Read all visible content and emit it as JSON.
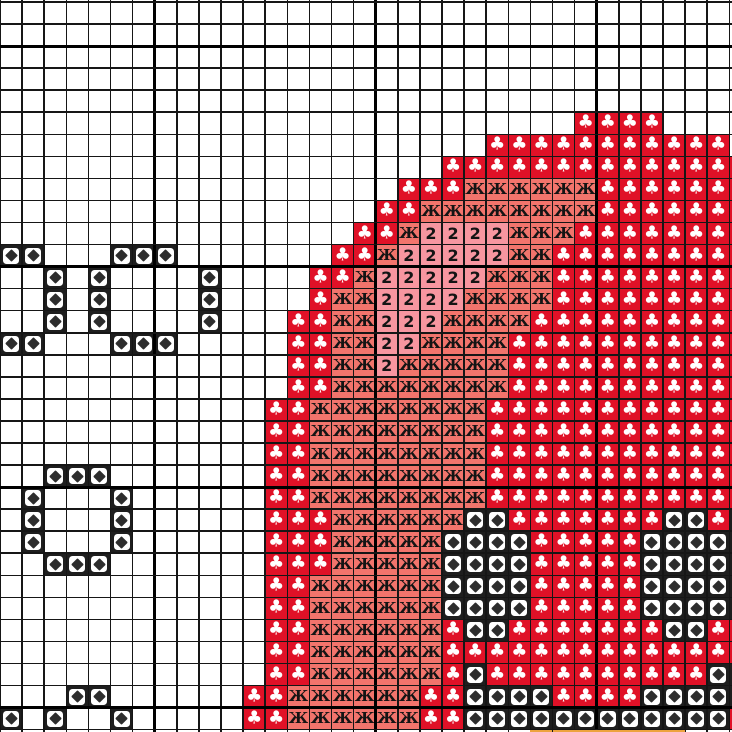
{
  "app": {
    "title": "Cross-stitch pattern chart",
    "description": "Grid pattern chart with symbol cells; no other UI chrome visible"
  },
  "colors": {
    "background": "#FFFFFF",
    "grid_minor_line": "#161616",
    "grid_major_line": "#000000",
    "clover_red": "#E01127",
    "zhe_salmon": "#F2746C",
    "two_pink": "#F796A0",
    "diamond_black": "#1E1E1E",
    "diamond_inset_white": "#FFFFFF",
    "diamond_glyph": "#2D2D2D",
    "orange_strip": "#EDA33E",
    "symbol_text": "#141414",
    "clover_glyph_white": "#FFFFFF"
  },
  "grid": {
    "columns": 34,
    "rows": 34,
    "major_line_every": 10,
    "major_col_mod": 7,
    "major_row_mod": 2
  },
  "symbols": {
    "C": {
      "name": "clover",
      "glyph": "♣",
      "bg": "#E01127",
      "fg": "#FFFFFF"
    },
    "Z": {
      "name": "zhe",
      "glyph": "Ж",
      "bg": "#F2746C",
      "fg": "#141414"
    },
    "2": {
      "name": "two",
      "glyph": "2",
      "bg": "#F796A0",
      "fg": "#141414"
    },
    "D": {
      "name": "diamond",
      "glyph": "◆",
      "bg": "#1E1E1E",
      "fg": "#2D2D2D",
      "inset": "#FFFFFF"
    },
    "O": {
      "name": "orange-strip",
      "glyph": "",
      "bg": "#EDA33E"
    }
  },
  "pattern_rows": [
    "..................................",
    "..................................",
    "..................................",
    "..................................",
    "..................................",
    "..........................CCCC....",
    "......................CCCCCCCCCCC.",
    "....................CCCCCCCCCCCCCC",
    "..................CCCZZZZZZCCCCCCC",
    ".................CCZZZZZZZZCCCCCCC",
    "................CCZ2222ZZZCCCCCCCC",
    "DD...DDD.......CCZ22222ZZCCCCCCCCC",
    "..D.D....D....CCZ22222ZZZCCCCCCCCC",
    "..D.D....D....CZZ2222ZZZZCCCCCCCCC",
    "..D.D....D...CCZZ222ZZZZCCCCCCCCCC",
    "DD...DDD.....CCZZ22ZZZZCCCCCCCCCCC",
    ".............CCZZ2ZZZZZCCCCCCCCCCC",
    ".............CCZZZZZZZZCCCCCCCCCCC",
    "............CCZZZZZZZZCCCCCCCCCCCC",
    "............CCZZZZZZZZCCCCCCCCCCCC",
    "............CCZZZZZZZZCCCCCCCCCCCC",
    "..DDD.......CCZZZZZZZZCCCCCCCCCCCC",
    ".D...D......CCZZZZZZZZCCCCCCCCCCCC",
    ".D...D......CCCZZZZZZDDCCCCCCCDDCD",
    ".D...D......CCCZZZZZDDDDCCCCCDDDDD",
    "..DDD.......CCCZZZZZDDDDCCCCCDDDDD",
    "............CCZZZZZZDDDDCCCCCDDDDD",
    "............CCZZZZZZDDDDCCCCCDDDDD",
    "............CCZZZZZZCDDCCCCCCCDDCC",
    "............CCZZZZZZCCCCCCCCCCCCCC",
    "............CCZZZZZZCDCCCCCCCCCCDD",
    "...DD......CCZZZZZZCCDDDDCCCCDDDDD",
    "D.D..D.....CCZZZZZZCCDDDDDDDDDDDDC",
    "........................OOOOOOO..."
  ]
}
